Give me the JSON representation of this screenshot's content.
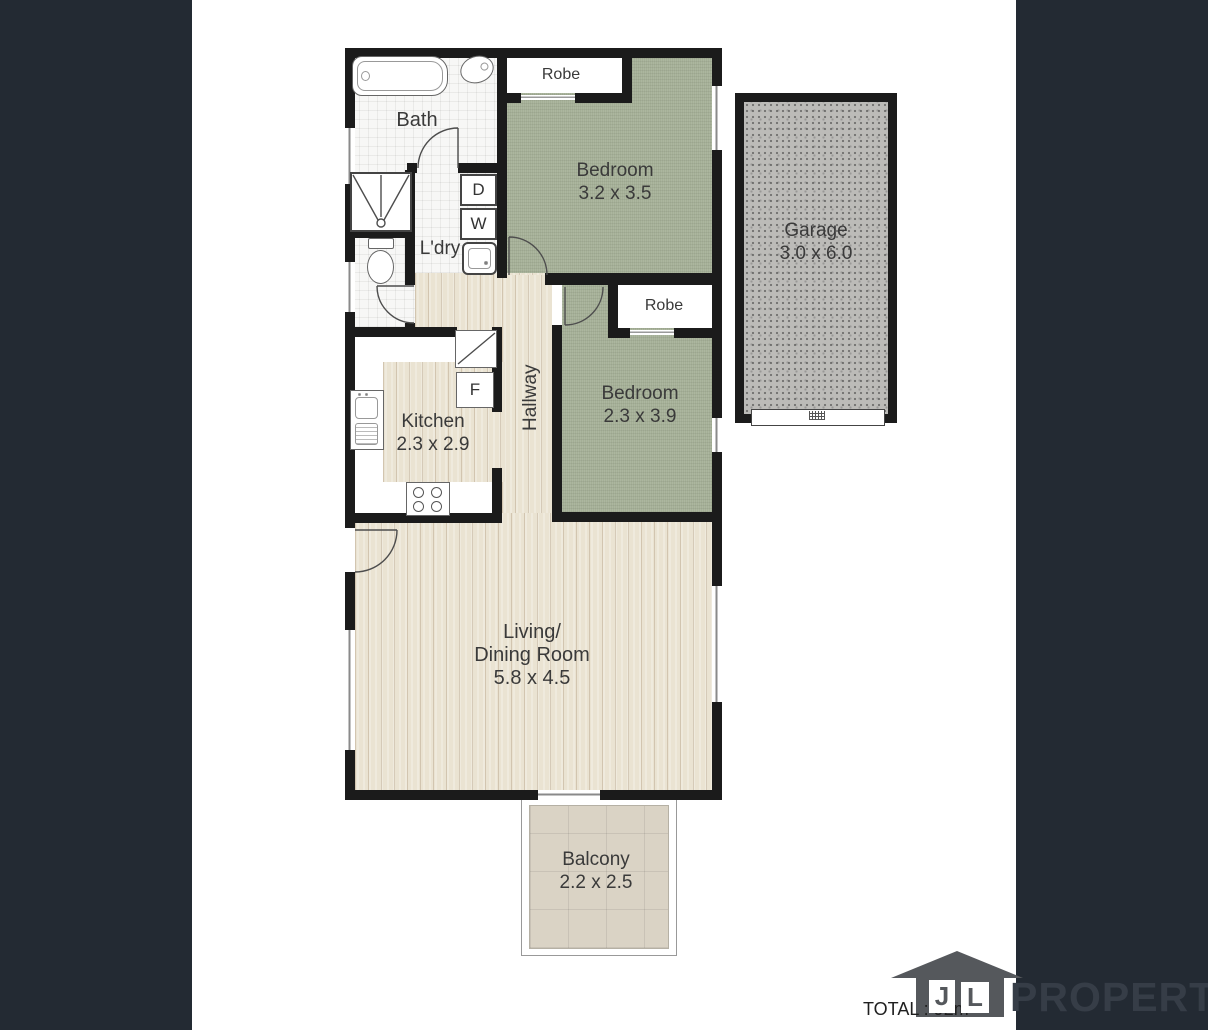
{
  "plan": {
    "rooms": {
      "bath": {
        "label": "Bath"
      },
      "laundry": {
        "label": "L'dry"
      },
      "bedroom1": {
        "label": "Bedroom",
        "dims": "3.2 x 3.5"
      },
      "robe1": {
        "label": "Robe"
      },
      "garage": {
        "label": "Garage",
        "dims": "3.0 x 6.0"
      },
      "kitchen": {
        "label": "Kitchen",
        "dims": "2.3 x 2.9"
      },
      "hallway": {
        "label": "Hallway"
      },
      "bedroom2": {
        "label": "Bedroom",
        "dims": "2.3 x 3.9"
      },
      "robe2": {
        "label": "Robe"
      },
      "living": {
        "label": "Living/",
        "label2": "Dining Room",
        "dims": "5.8 x 4.5"
      },
      "balcony": {
        "label": "Balcony",
        "dims": "2.2 x 2.5"
      }
    },
    "appliances": {
      "dryer": "D",
      "washer": "W",
      "fridge": "F"
    }
  },
  "footer": {
    "total": "TOTAL : 92m²",
    "logo": {
      "initial1": "J",
      "initial2": "L",
      "name": "PROPERTY"
    }
  },
  "colors": {
    "side_panel": "#232a33",
    "wall": "#1b1b1b",
    "bedroom_floor": "#a4af96",
    "wood_floor": "#eae3d2",
    "garage_floor": "#bcbbb8",
    "balcony_floor": "#dad3c5",
    "logo_gray": "#55585c"
  }
}
